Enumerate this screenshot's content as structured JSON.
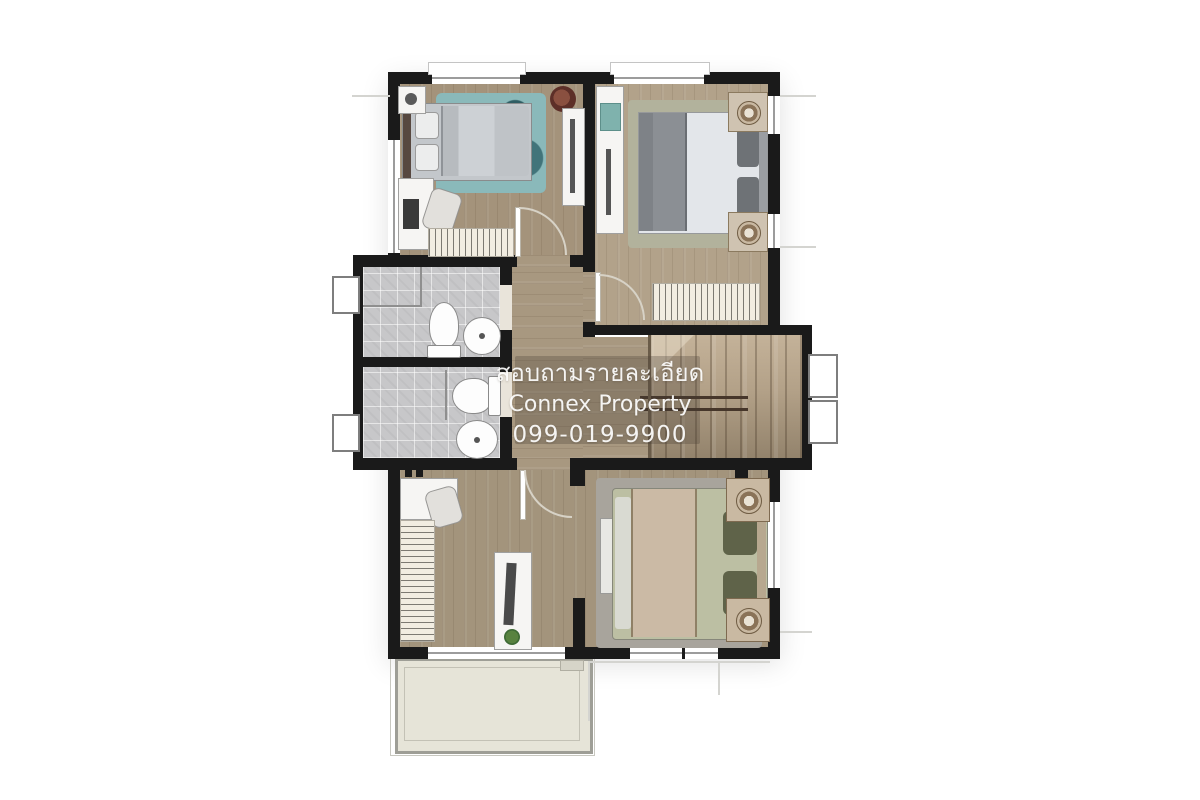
{
  "watermark": {
    "line1": "สอบถามรายละเอียด",
    "line2": "Connex Property",
    "line3": "099-019-9900"
  },
  "palette": {
    "wall": "#1a1a1a",
    "wood_floor": "#a89880",
    "wood_floor_light": "#b2a28a",
    "bath_tile": "#c7c7c9",
    "stairs_wood": "#b3a188",
    "balcony_floor": "#e6e4d8",
    "rug_teal": "#8ab9ba",
    "rug_sage": "#b2b29c",
    "master_rug": "#a8a49c",
    "bed_duvet_gray": "#c3c7cb",
    "bed_duvet_white": "#e3e6ea",
    "master_bed_sage": "#bcbfa3",
    "blanket_tan": "#cbbaa5",
    "wardrobe_hatch": "#f2ede1",
    "watermark_text": "#ffffff"
  }
}
